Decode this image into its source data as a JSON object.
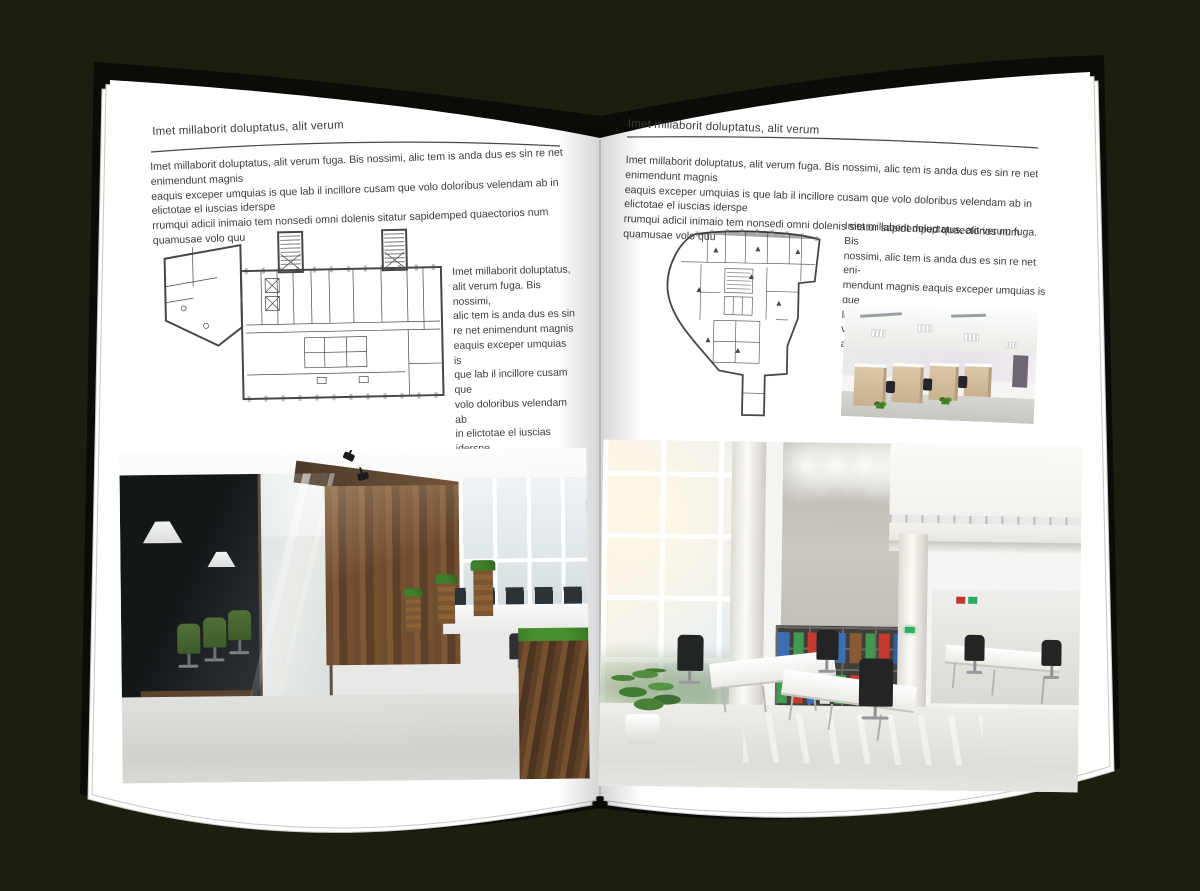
{
  "meta": {
    "background_color": "#1d1e10",
    "page_color": "#ffffff",
    "text_color": "#3b3b3b"
  },
  "left_page": {
    "header": "Imet millaborit doluptatus, alit verum",
    "intro": "Imet millaborit doluptatus, alit verum fuga. Bis nossimi, alic tem is anda dus es sin re net enimendunt magnis\neaquis exceper umquias is que lab il incillore cusam que volo doloribus velendam ab in elictotae el iuscias iderspe\nrrumqui adicil inimaio tem nonsedi omni dolenis sitatur sapidemped quaectorios num quamusae volo quu",
    "side_text": "Imet millaborit doluptatus,\nalit verum fuga. Bis nossimi,\nalic tem is anda dus es sin\nre net enimendunt magnis\neaquis exceper umquias is\nque lab il incillore cusam que\nvolo doloribus velendam ab\nin elictotae el iuscias iderspe\nrrumqui adicil inimaio tem\nnonsedi omni dolenis sitatur\nsapidemped quaectorios num\nquamusae volo quu",
    "floor_plan_label": "rectangular-office-floor-plan-with-two-stair-towers",
    "photo_label": "dark-glass-meeting-room-and-wood-panel-open-office"
  },
  "right_page": {
    "header": "Imet millaborit doluptatus, alit verum",
    "intro": "Imet millaborit doluptatus, alit verum fuga. Bis nossimi, alic tem is anda dus es sin re net enimendunt magnis\neaquis exceper umquias is que lab il incillore cusam que volo doloribus velendam ab in elictotae el iuscias iderspe\nrrumqui adicil inimaio tem nonsedi omni dolenis sitatur sapidemped quaectorios num quamusae volo quu",
    "side_text": "Imet millaborit doluptatus, alit verum fuga. Bis\nnossimi, alic tem is anda dus es sin re net eni-\nmendunt magnis eaquis exceper umquias is que\nlab il incillore cusam que volo doloribus velendam\nab in elictotae el iuscias iders",
    "floor_plan_label": "wedge-shaped-office-floor-plan",
    "photo_small_label": "open-plan-cubicle-office-with-panel-lights",
    "photo_large_label": "double-height-bright-office-with-binder-bookshelf"
  }
}
